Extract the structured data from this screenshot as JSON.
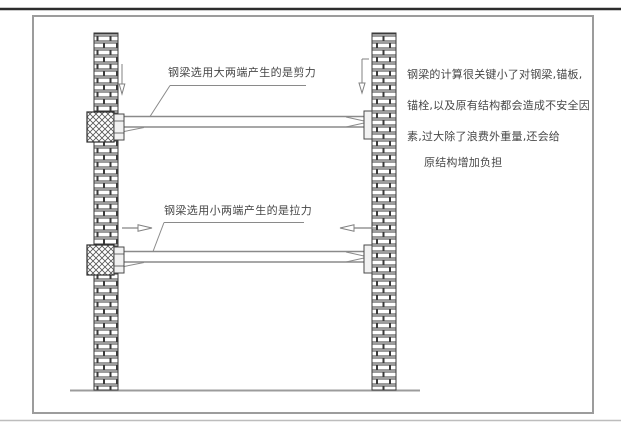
{
  "figure": {
    "background": "#ffffff",
    "top_rule_color": "#2d2d2d",
    "frame_border_color": "#9c9c9c",
    "diagram_line_color": "#8a8a8a",
    "wall_line_color": "#3a3a3a",
    "text_color": "#474747"
  },
  "annotations": {
    "upper_beam_caption": "钢梁选用大两端产生的是剪力",
    "lower_beam_caption": "钢梁选用小两端产生的是拉力",
    "note_lines": [
      "钢梁的计算很关键小了对钢梁,锚板,",
      "锚栓,以及原有结构都会造成不安全因",
      "素,过大除了浪费外重量,还会给",
      "原结构增加负担"
    ]
  }
}
